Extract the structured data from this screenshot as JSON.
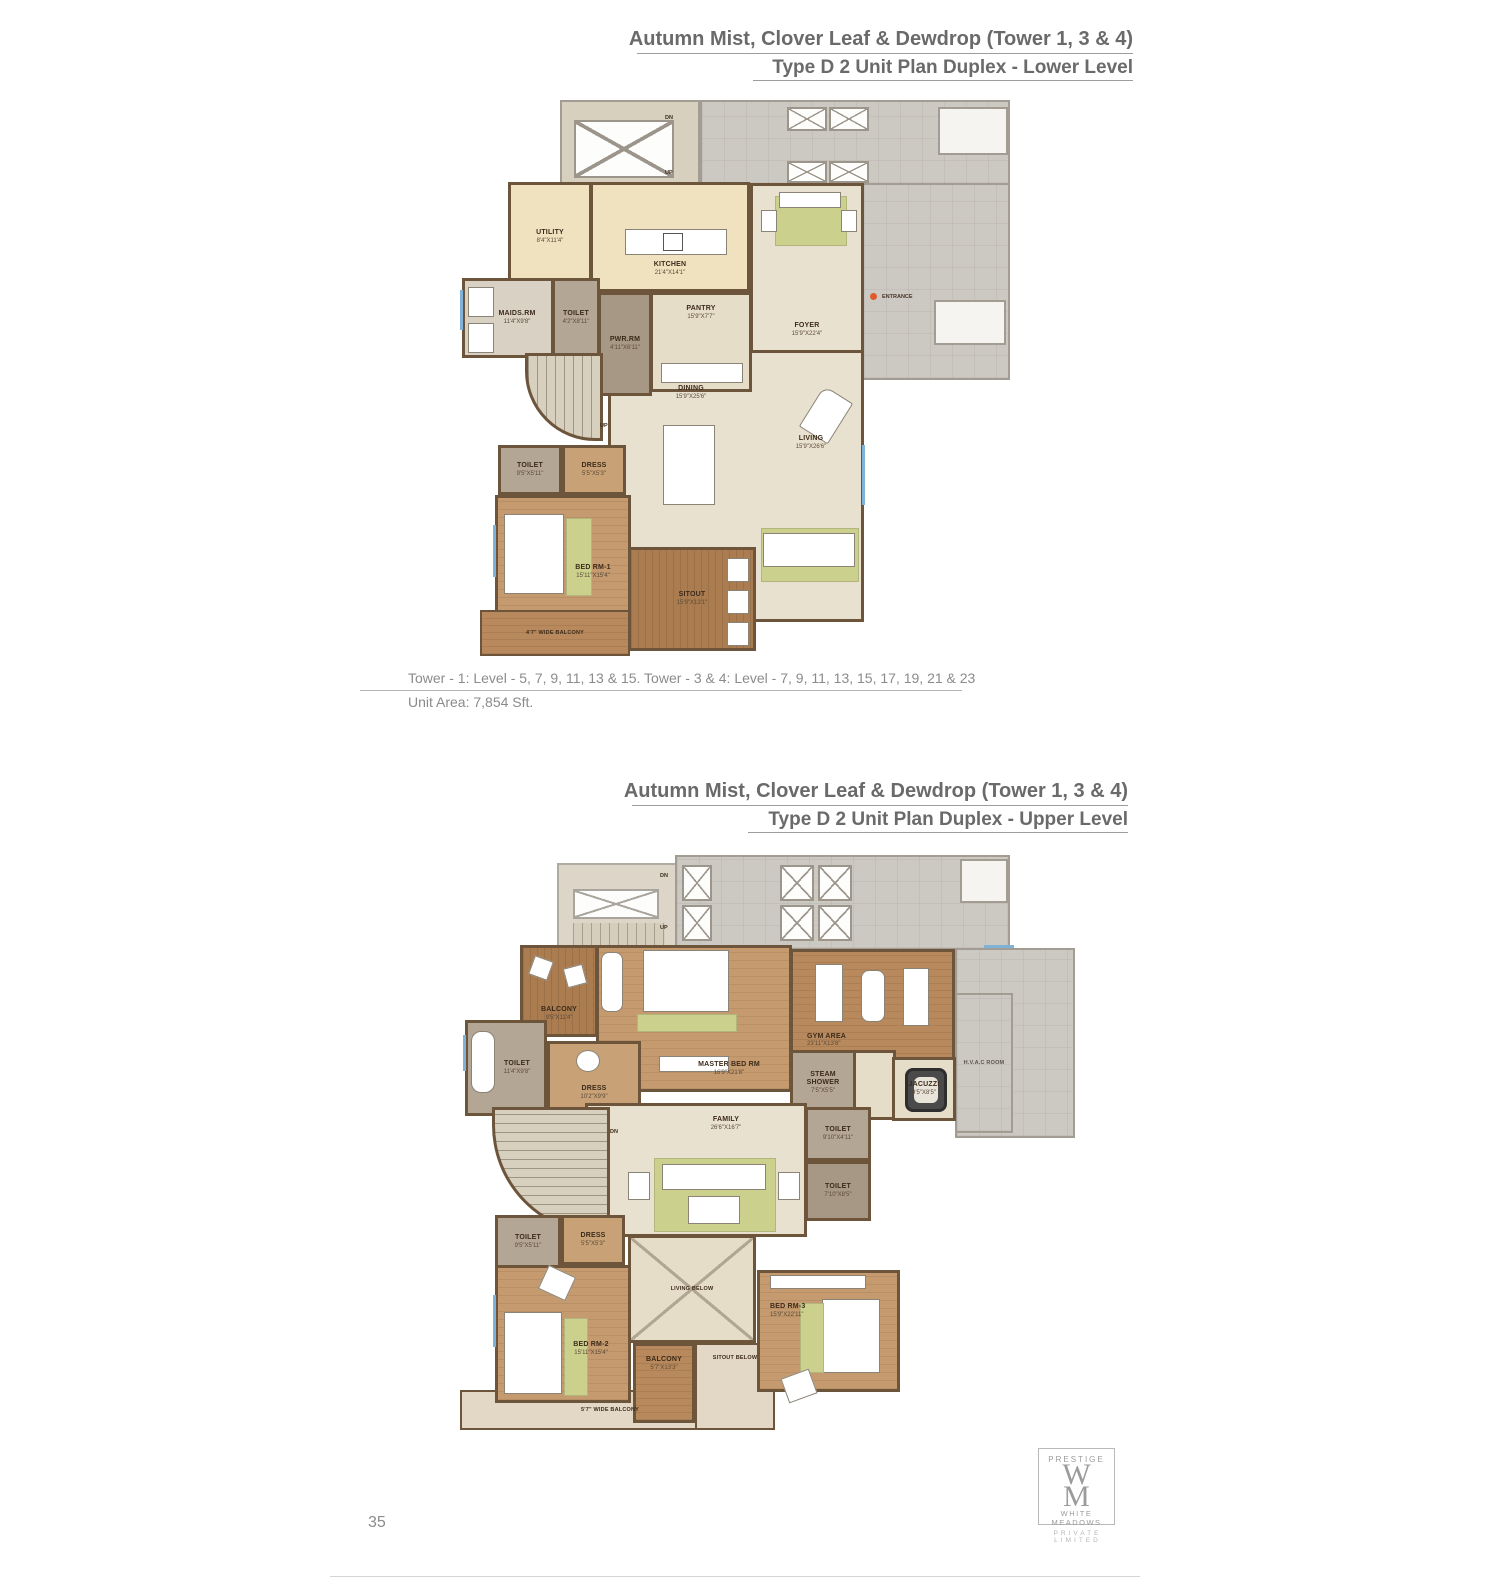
{
  "page_number": "35",
  "plans": {
    "lower": {
      "title": "Autumn Mist, Clover Leaf & Dewdrop (Tower 1, 3 & 4)",
      "subtitle": "Type D 2 Unit Plan Duplex - Lower Level",
      "caption_levels": "Tower - 1: Level - 5, 7, 9, 11, 13 & 15. Tower - 3 & 4: Level - 7, 9, 11, 13, 15, 17, 19, 21 & 23",
      "caption_area": "Unit Area: 7,854 Sft.",
      "rooms": [
        {
          "name": "UTILITY",
          "dims": "8'4\"X11'4\""
        },
        {
          "name": "KITCHEN",
          "dims": "21'4\"X14'1\""
        },
        {
          "name": "PANTRY",
          "dims": "15'9\"X7'7\""
        },
        {
          "name": "MAIDS.RM",
          "dims": "11'4\"X9'8\""
        },
        {
          "name": "TOILET",
          "dims": "4'2\"X8'11\""
        },
        {
          "name": "PWR.RM",
          "dims": "4'11\"X6'11\""
        },
        {
          "name": "FOYER",
          "dims": "15'9\"X22'4\""
        },
        {
          "name": "DINING",
          "dims": "15'9\"X25'6\""
        },
        {
          "name": "LIVING",
          "dims": "15'9\"X26'6\""
        },
        {
          "name": "TOILET",
          "dims": "9'5\"X5'11\""
        },
        {
          "name": "DRESS",
          "dims": "5'5\"X5'3\""
        },
        {
          "name": "BED RM-1",
          "dims": "15'11\"X15'4\""
        },
        {
          "name": "SITOUT",
          "dims": "15'9\"X13'1\""
        }
      ],
      "labels": {
        "up": "UP",
        "dn": "DN",
        "entrance": "ENTRANCE",
        "wide_balcony": "4'7\" WIDE BALCONY"
      }
    },
    "upper": {
      "title": "Autumn Mist, Clover Leaf & Dewdrop (Tower 1, 3 & 4)",
      "subtitle": "Type D 2 Unit Plan Duplex - Upper Level",
      "rooms": [
        {
          "name": "BALCONY",
          "dims": "9'5\"X11'4\""
        },
        {
          "name": "MASTER BED RM",
          "dims": "16'9\"X21'8\""
        },
        {
          "name": "GYM AREA",
          "dims": "23'11\"X13'8\""
        },
        {
          "name": "TOILET",
          "dims": "11'4\"X9'8\""
        },
        {
          "name": "DRESS",
          "dims": "10'2\"X9'9\""
        },
        {
          "name": "STEAM SHOWER",
          "dims": "7'5\"X5'5\""
        },
        {
          "name": "JACUZZI",
          "dims": "9'5\"X8'5\""
        },
        {
          "name": "H.V.A.C ROOM",
          "dims": ""
        },
        {
          "name": "TOILET",
          "dims": "9'10\"X4'11\""
        },
        {
          "name": "TOILET",
          "dims": "7'10\"X8'5\""
        },
        {
          "name": "FAMILY",
          "dims": "26'6\"X16'7\""
        },
        {
          "name": "LIVING BELOW",
          "dims": ""
        },
        {
          "name": "TOILET",
          "dims": "9'5\"X5'11\""
        },
        {
          "name": "DRESS",
          "dims": "5'5\"X5'3\""
        },
        {
          "name": "BED RM-2",
          "dims": "15'11\"X15'4\""
        },
        {
          "name": "BALCONY",
          "dims": "5'7\"X13'3\""
        },
        {
          "name": "SITOUT BELOW",
          "dims": ""
        },
        {
          "name": "BED RM-3",
          "dims": "15'9\"X22'11\""
        }
      ],
      "labels": {
        "up": "UP",
        "dn": "DN",
        "wide_balcony": "5'7\" WIDE BALCONY"
      }
    }
  },
  "logo": {
    "brand": "PRESTIGE",
    "monogram_top": "W",
    "monogram_bottom": "M",
    "name": "WHITE MEADOWS",
    "subname": "PRIVATE LIMITED"
  },
  "colors": {
    "wall": "#6d553c",
    "wood_floor": "#c49a6e",
    "wood_dark": "#aa7c50",
    "beige_floor": "#e9e1cf",
    "kitchen_tile": "#f0e2bf",
    "common_gray": "#ccc8c2",
    "toilet_floor": "#b4a694",
    "rug_green": "#ccd08d",
    "entrance_dot": "#e05a2b",
    "title_text": "#6a6a6a"
  }
}
